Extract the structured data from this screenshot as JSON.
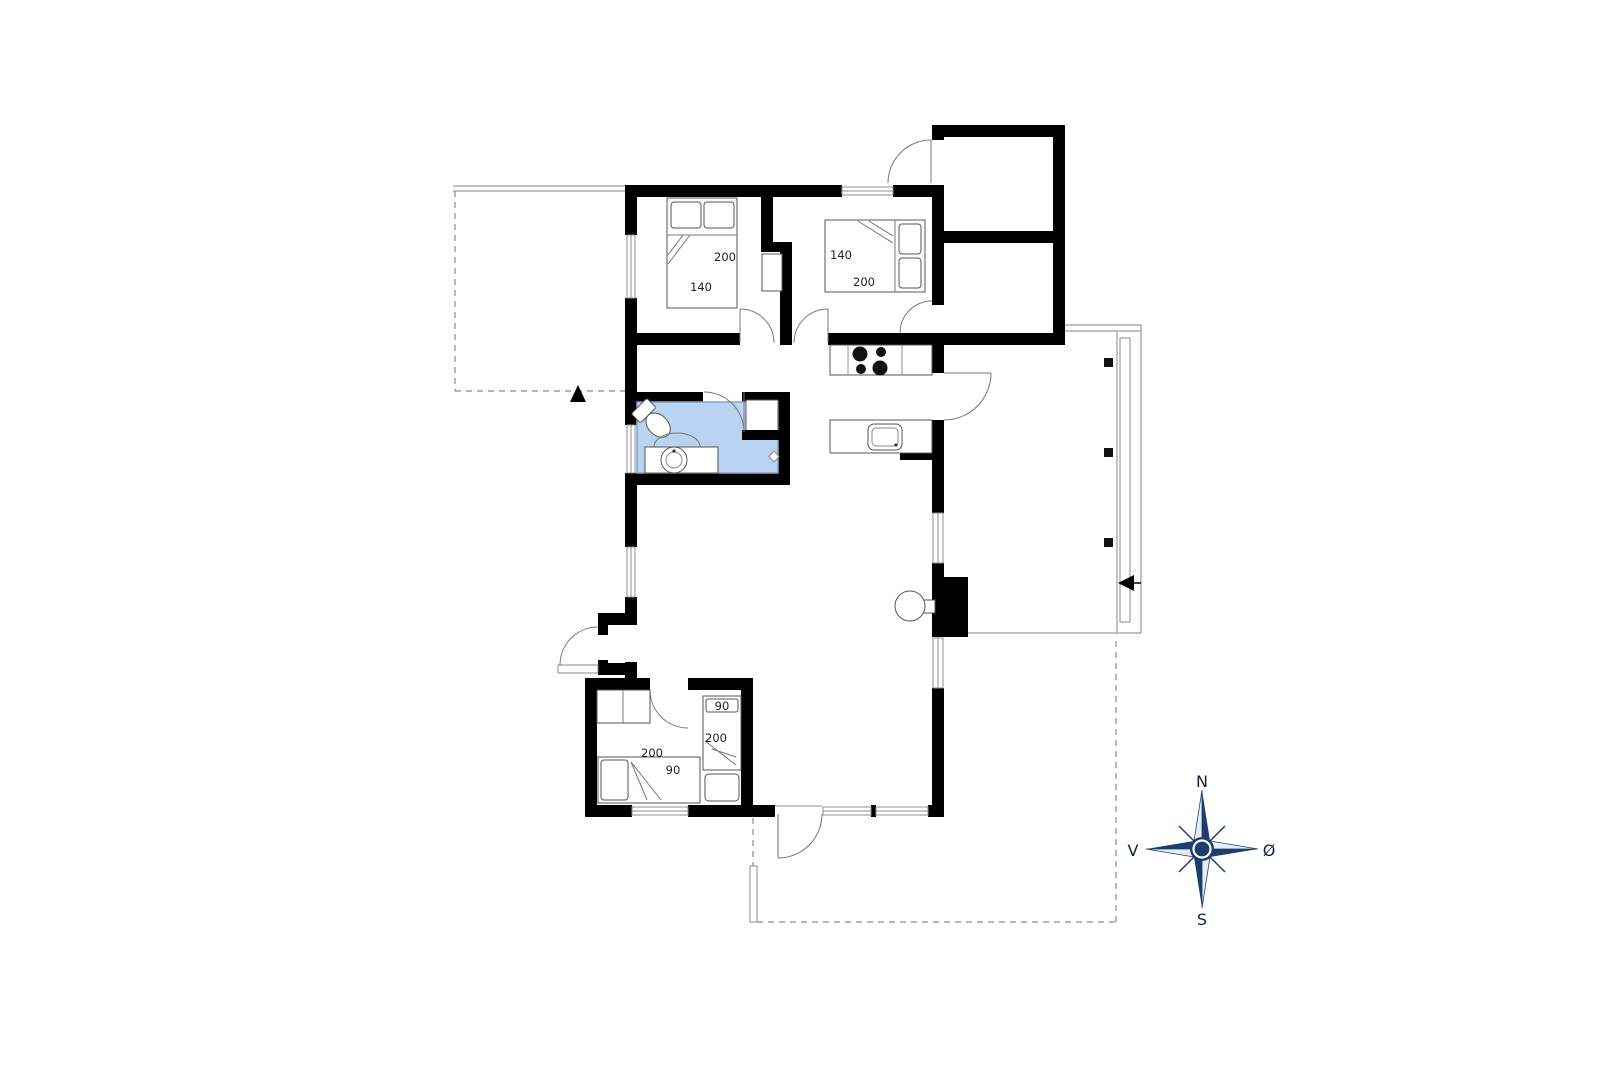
{
  "floorplan": {
    "compass": {
      "north": "N",
      "south": "S",
      "west": "V",
      "east": "Ø"
    },
    "colors": {
      "wall": "#000000",
      "bathroom_floor": "#b9d3f0",
      "bathroom_border": "#84a3c8",
      "compass_navy": "#1d3d6e",
      "compass_light": "#e9eef5"
    },
    "beds": [
      {
        "room": "bedroom-1",
        "type": "double",
        "length_label": "200",
        "width_label": "140"
      },
      {
        "room": "bedroom-2",
        "type": "double",
        "length_label": "200",
        "width_label": "140"
      },
      {
        "room": "bedroom-3",
        "type": "single-vertical",
        "length_label": "200",
        "width_label": "90"
      },
      {
        "room": "bedroom-3",
        "type": "single-horizontal",
        "length_label": "200",
        "width_label": "90"
      }
    ]
  }
}
